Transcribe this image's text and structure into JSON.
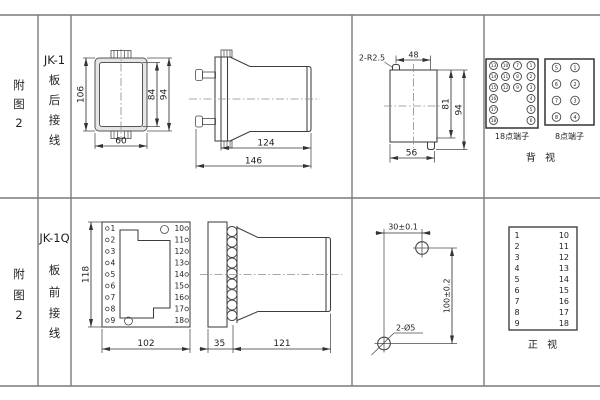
{
  "top": {
    "figure": [
      "附",
      "图",
      "2"
    ],
    "model": "JK-1",
    "wiring": [
      "板",
      "后",
      "接",
      "线"
    ],
    "rear": {
      "height": "106",
      "inner": "84",
      "outer": "94",
      "width": "60"
    },
    "side": {
      "body": "124",
      "total": "146"
    },
    "cutout": {
      "radius": "2-R2.5",
      "top": "48",
      "right_inner": "81",
      "right_outer": "94",
      "bottom": "56"
    },
    "t18": {
      "label": "18点端子",
      "col1": [
        "13",
        "14",
        "15",
        "16",
        "17",
        "18"
      ],
      "col2": [
        "10",
        "11",
        "12"
      ],
      "col3": [
        "7",
        "8",
        "9"
      ],
      "col4": [
        "1",
        "2",
        "3",
        "4",
        "5",
        "6"
      ]
    },
    "t8": {
      "label": "8点端子",
      "left": [
        "5",
        "6",
        "7",
        "8"
      ],
      "right": [
        "1",
        "2",
        "3",
        "4"
      ]
    },
    "view_label": "背  视"
  },
  "bottom": {
    "figure": [
      "附",
      "图",
      "2"
    ],
    "model": "JK-1Q",
    "wiring": [
      "板",
      "前",
      "接",
      "线"
    ],
    "front": {
      "height": "118",
      "width": "102",
      "left": [
        "1",
        "2",
        "3",
        "4",
        "5",
        "6",
        "7",
        "8",
        "9"
      ],
      "right": [
        "10",
        "11",
        "12",
        "13",
        "14",
        "15",
        "16",
        "17",
        "18"
      ]
    },
    "side": {
      "plate": "35",
      "body": "121"
    },
    "drill": {
      "h": "30±0.1",
      "v": "100±0.2",
      "label": "2-Ø5"
    },
    "table": {
      "left": [
        "1",
        "2",
        "3",
        "4",
        "5",
        "6",
        "7",
        "8",
        "9"
      ],
      "right": [
        "10",
        "11",
        "12",
        "13",
        "14",
        "15",
        "16",
        "17",
        "18"
      ],
      "view_label": "正  视"
    }
  }
}
